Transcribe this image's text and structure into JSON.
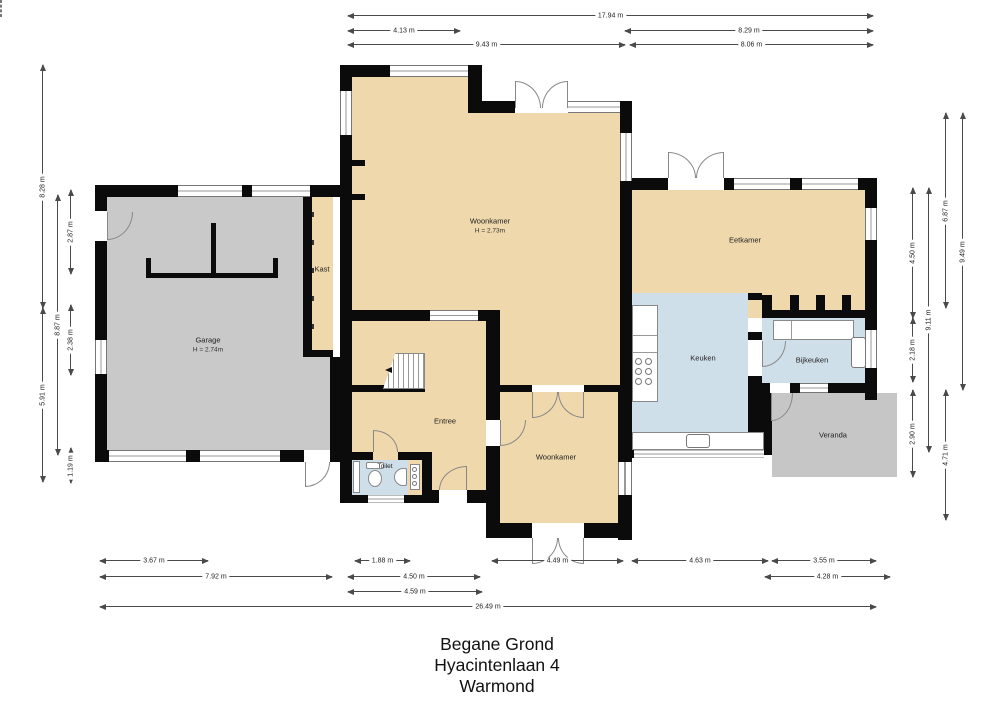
{
  "title": {
    "line1": "Begane Grond",
    "line2": "Hyacintenlaan 4",
    "line3": "Warmond"
  },
  "rooms": {
    "garage": {
      "name": "Garage",
      "height": "H = 2.74m"
    },
    "kast": {
      "name": "Kast"
    },
    "woonkamer_top": {
      "name": "Woonkamer",
      "height": "H = 2.73m"
    },
    "eetkamer": {
      "name": "Eetkamer"
    },
    "keuken": {
      "name": "Keuken"
    },
    "bijkeuken": {
      "name": "Bijkeuken"
    },
    "veranda": {
      "name": "Veranda"
    },
    "entree": {
      "name": "Entree"
    },
    "toilet": {
      "name": "Toilet"
    },
    "woonkamer_bottom": {
      "name": "Woonkamer"
    }
  },
  "dimensions": {
    "top": [
      "17.94 m",
      "4.13 m",
      "9.43 m",
      "8.29 m",
      "8.06 m"
    ],
    "left": [
      "8.28 m",
      "5.91 m",
      "8.87 m",
      "2.87 m",
      "2.38 m",
      "1.19 m"
    ],
    "right": [
      "4.50 m",
      "2.18 m",
      "2.90 m",
      "9.11 m",
      "6.87 m",
      "4.71 m",
      "9.49 m"
    ],
    "bottom": [
      "3.67 m",
      "1.88 m",
      "4.49 m",
      "4.63 m",
      "3.55 m",
      "7.92 m",
      "4.50 m",
      "4.28 m",
      "4.59 m",
      "26.49 m"
    ]
  },
  "colors": {
    "floor_tan": "#efd8ab",
    "floor_gray": "#c9c9c9",
    "floor_blue": "#cfdfe9",
    "veranda_gray": "#c6c6c6",
    "wall": "#0b0b0b"
  }
}
